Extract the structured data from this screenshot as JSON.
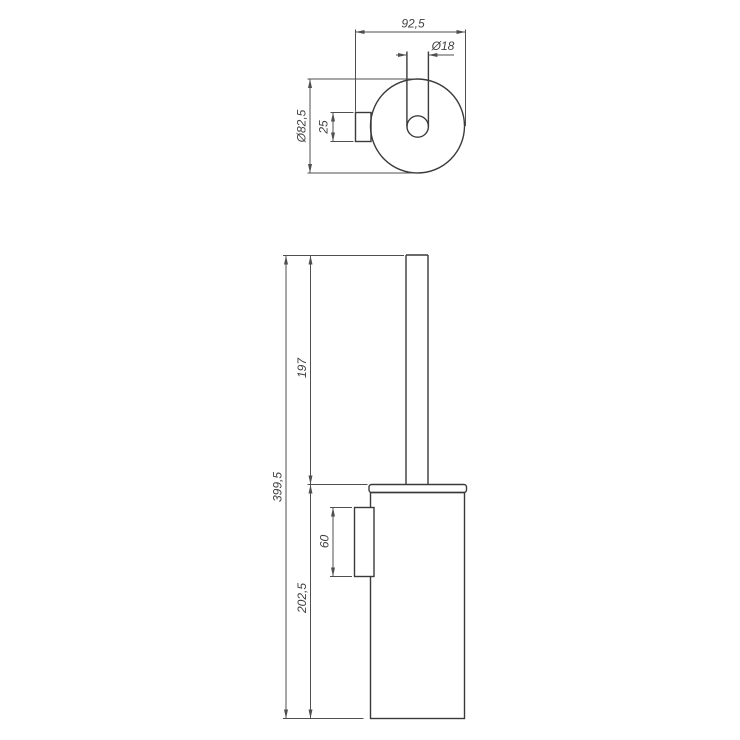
{
  "drawing": {
    "type": "technical-dimension-drawing",
    "subject": "wall-mounted toilet brush holder, two orthographic views",
    "colors": {
      "line_color": "#3a3a3a",
      "dim_color": "#4f4f4f",
      "text_color": "#3f3f3f",
      "background": "#ffffff"
    },
    "top_view": {
      "overall_depth": "92,5",
      "handle_diameter": "Ø18",
      "container_diameter": "Ø82,5",
      "bracket_depth": "25"
    },
    "front_view": {
      "total_height": "399,5",
      "handle_height": "197",
      "container_height": "202,5",
      "bracket_height": "60"
    }
  }
}
